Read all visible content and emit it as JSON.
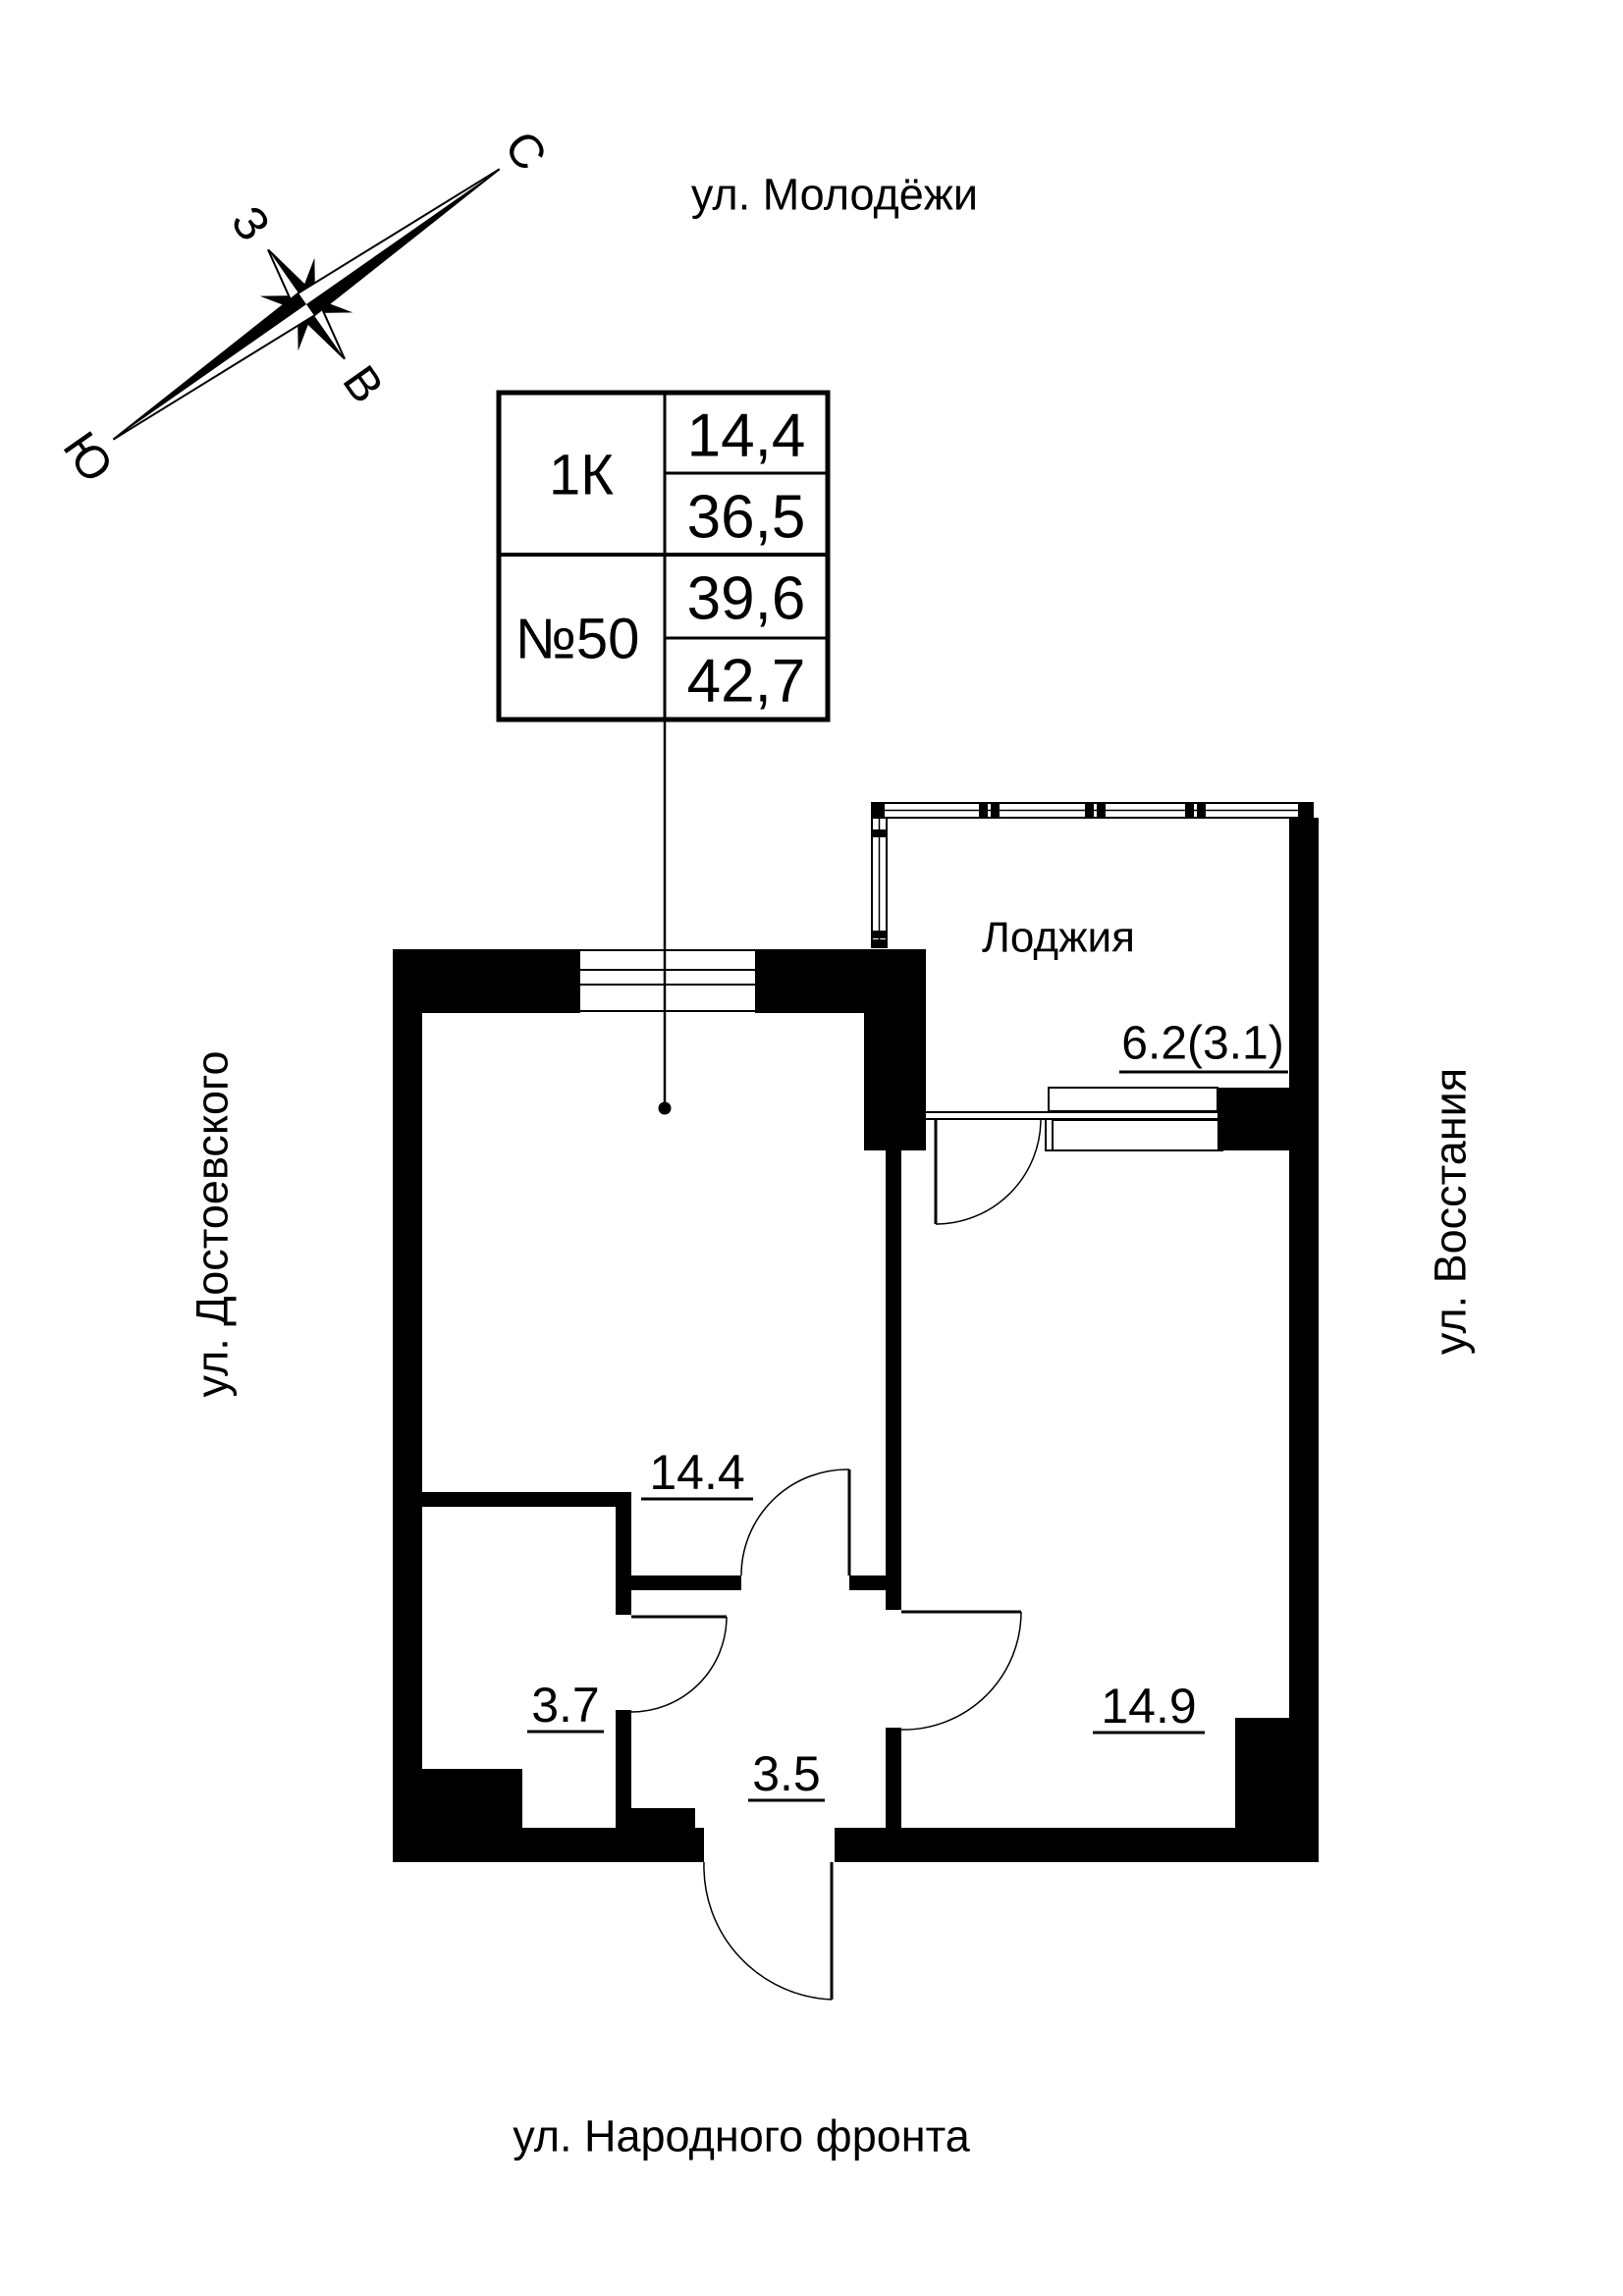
{
  "compass": {
    "north": "С",
    "south": "Ю",
    "west": "З",
    "east": "В"
  },
  "streets": {
    "top": "ул. Молодёжи",
    "left": "ул. Достоевского",
    "right": "ул. Восстания",
    "bottom": "ул. Народного фронта"
  },
  "info_table": {
    "type": "1К",
    "number": "№50",
    "values": [
      "14,4",
      "36,5",
      "39,6",
      "42,7"
    ]
  },
  "rooms": {
    "living": {
      "area": "14.4"
    },
    "closet": {
      "area": "3.7"
    },
    "hall": {
      "area": "3.5"
    },
    "bedroom": {
      "area": "14.9"
    },
    "loggia": {
      "label": "Лоджия",
      "area": "6.2(3.1)"
    }
  },
  "colors": {
    "ink": "#000000",
    "paper": "#ffffff"
  }
}
